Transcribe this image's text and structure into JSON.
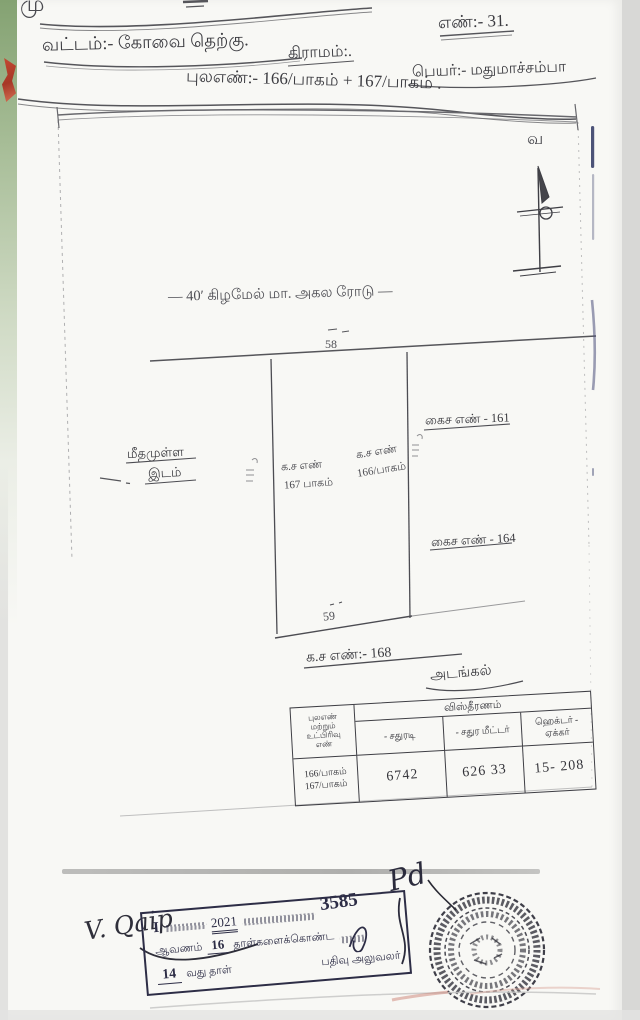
{
  "document": {
    "top_fragment": "மு",
    "number": "எண்:- 31.",
    "district": "வட்டம்:- கோவை தெற்கு.",
    "village": "கிராமம்:.",
    "owner_name": "பெயர்:- மதுமாச்சம்பா",
    "survey_line": "புலஎண்:- 166/பாகம் + 167/பாகம் ."
  },
  "compass": {
    "north_letter": "வ"
  },
  "sketch": {
    "road_label": "— 40′ கிழமேல் மா. அகல ரோடு —",
    "top_width": "58",
    "bottom_width": "59",
    "plot_left": {
      "line1": "க.ச எண்",
      "line2": "167 பாகம்"
    },
    "plot_right": {
      "line1": "க.ச எண்",
      "line2": "166/பாகம்"
    },
    "east_label_top": "கைச எண் - 161",
    "east_label_bottom": "கைச எண் - 164",
    "west_label": {
      "line1": "மீதமுள்ள",
      "line2": "இடம்"
    },
    "south_label": "க.ச எண்:- 168"
  },
  "table": {
    "title": "அடங்கல்",
    "area_header": "விஸ்தீரணம்",
    "row_header_lines": [
      "புலஎண்",
      "மற்றும்",
      "உட்பிரிவு",
      "எண்"
    ],
    "columns": [
      "- சதுரடி",
      "- சதுர மீட்டர்",
      "ஹெக்டர் - ஏக்கர்"
    ],
    "row": {
      "plot1": "166/பாகம்",
      "plot2": "167/பாகம்",
      "sq_ft": "6742",
      "sq_m": "626 33",
      "hectare_acre": "15- 208"
    }
  },
  "endorsement": {
    "signature": "V. Qaip",
    "flourish": "Pd",
    "stamp": {
      "prefix": "I",
      "year": "2021",
      "doc_number": "3585",
      "line2_label1": "ஆவணம்",
      "line2_count": "16",
      "line2_label2": "தாள்களைக்கொண்ட",
      "line3_page": "14",
      "line3_label": "வது தாள்",
      "officer_label": "பதிவு அலுவலர்"
    }
  }
}
